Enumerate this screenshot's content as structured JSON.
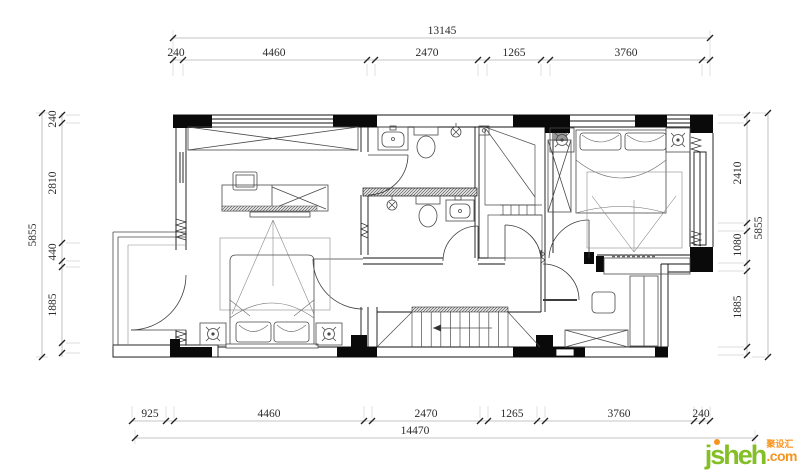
{
  "dimensions": {
    "top": {
      "overall": "13145",
      "segments": [
        "240",
        "4460",
        "2470",
        "1265",
        "3760"
      ]
    },
    "bottom": {
      "overall": "14470",
      "segments": [
        "925",
        "4460",
        "2470",
        "1265",
        "3760",
        "240"
      ]
    },
    "left": {
      "overall": "5855",
      "segments": [
        "240",
        "2810",
        "440",
        "1885"
      ]
    },
    "right": {
      "overall": "5855",
      "segments": [
        "2410",
        "1080",
        "1885"
      ]
    }
  },
  "watermark": {
    "brand": "jsheh",
    "tld": ".com",
    "cjk": "聚设汇"
  },
  "colors": {
    "wall": "#0a0a0a",
    "furniture": "#4a4a4a",
    "dimline": "#b0b0b0",
    "tick": "#222222",
    "brand_green": "#84bf28",
    "brand_orange": "#f7941d"
  }
}
